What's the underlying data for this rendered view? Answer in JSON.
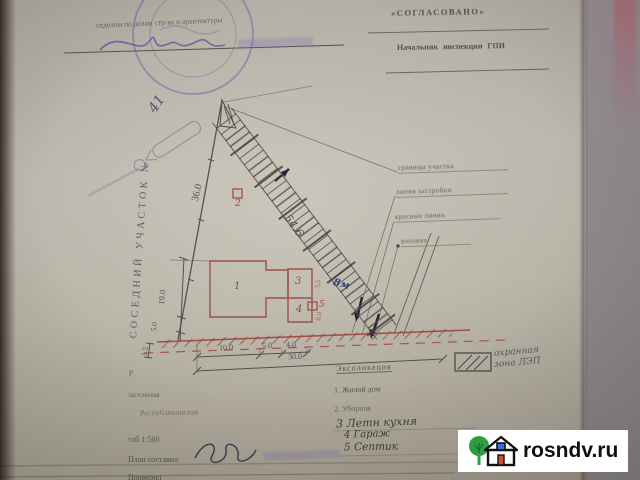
{
  "stamp_header": {
    "typed_line": "отделом по делам стр-ва и архитектуры"
  },
  "approval": {
    "title": "«СОГЛАСОВАНО»",
    "subtitle": "Начальник инспекции ГПИ"
  },
  "neighbor_label": "СОСЕДНИЙ УЧАСТОК №",
  "handwritten_note": "41",
  "plan": {
    "dim_left_boundary": "36.0",
    "dim_band": "54.6",
    "dim_depth": "19.0",
    "dim_side_small": "5.0",
    "dim_side_tiny": "1.5",
    "dim_front_1": "10.0",
    "dim_front_2": "5.0",
    "dim_front_3": "4.0",
    "dim_front_total": "30.0",
    "dim_gap_1": "3,5",
    "dim_gap_2": "6,0",
    "note_blue": "8м",
    "bld_1": "1",
    "bld_2": "2",
    "bld_3": "3",
    "bld_4": "4",
    "bld_5": "5",
    "callout_1": "границы участка",
    "callout_2": "линия застройки",
    "callout_3": "красные линии",
    "callout_4": "колонка"
  },
  "legend": {
    "line1": "охранная",
    "line2": "зона ЛЭП"
  },
  "explication": {
    "title": "Экспликация",
    "item_1": "1. Жилой дом",
    "item_2": "2. Уборная",
    "item_3": "3 Летн кухня",
    "item_4": "4 Гараж",
    "item_5": "5 Септик"
  },
  "form": {
    "line_1": "р",
    "line_2": "заселения",
    "street": "Республиканская",
    "scale": "таб 1:500",
    "composed_label": "План составил",
    "checked_label": "Проверил"
  },
  "watermark": {
    "site": "rosndv.ru"
  },
  "colors": {
    "paper": "#b9b4a9",
    "red_ink": "#9a5246",
    "purple_ink": "#7b6fae",
    "blue_pen": "#2f3f7e",
    "graphite": "#57514b"
  }
}
